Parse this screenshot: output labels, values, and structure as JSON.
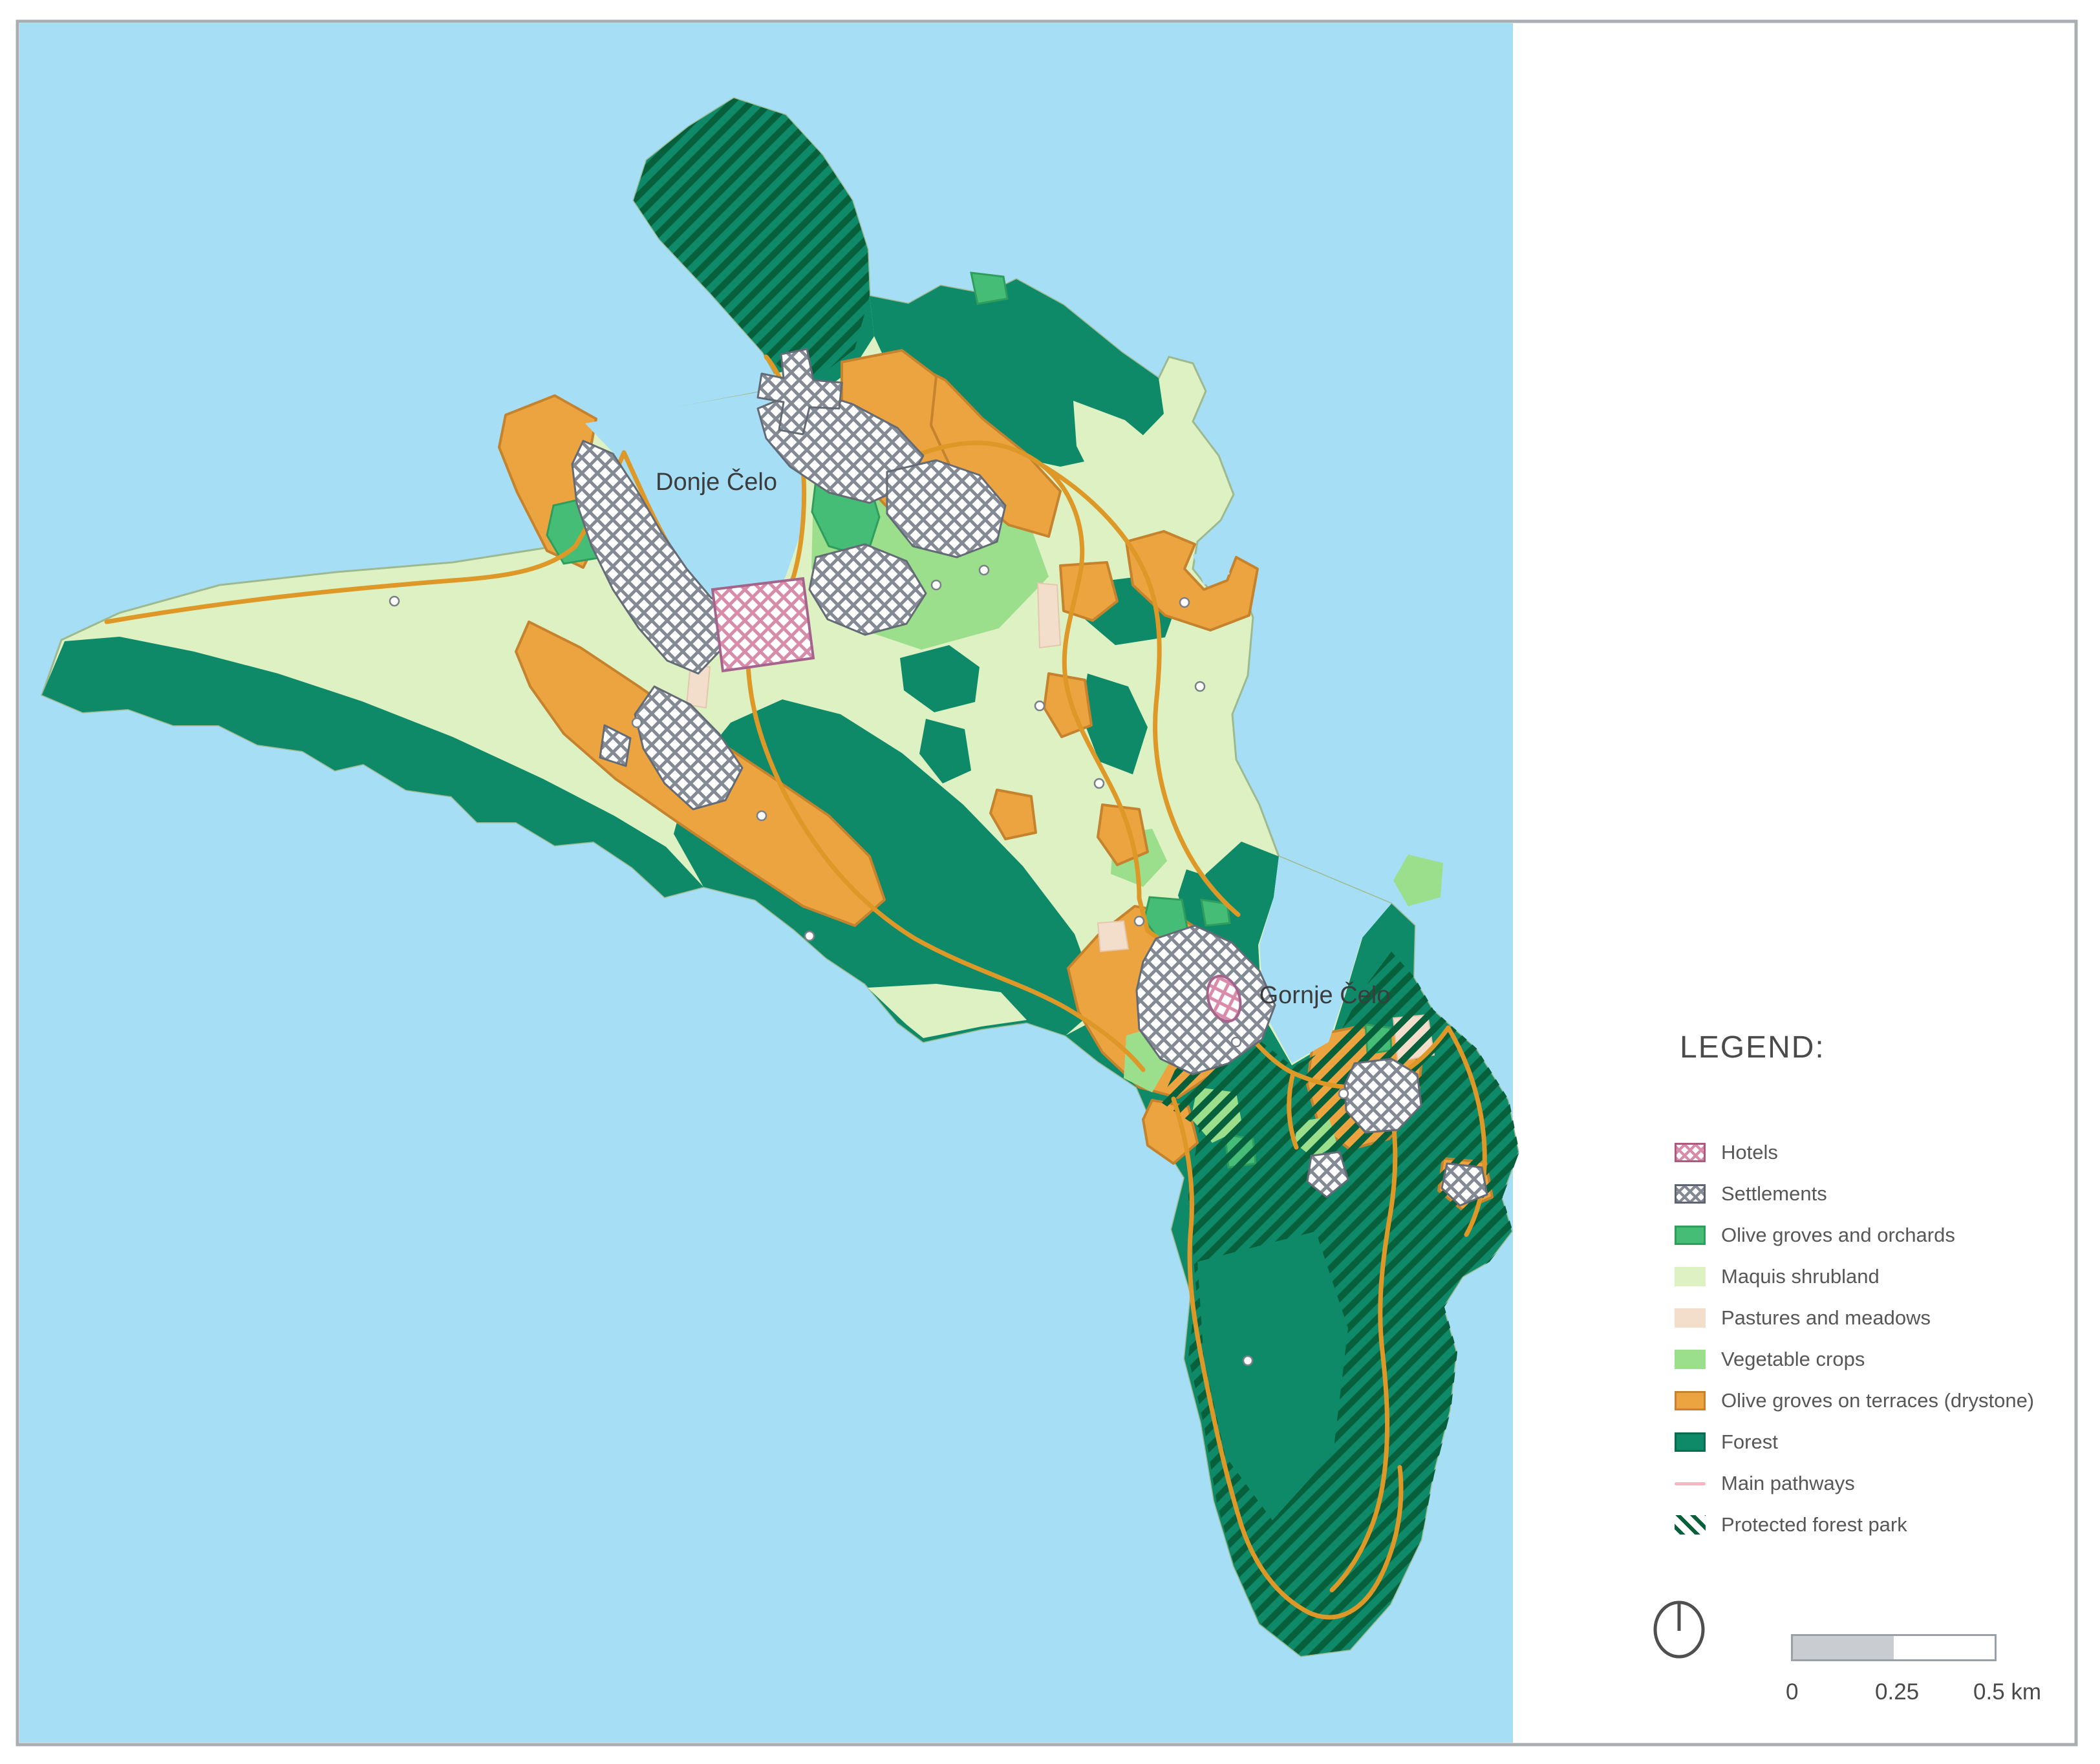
{
  "map": {
    "labels": {
      "settlement_1": "Donje Čelo",
      "settlement_2": "Gornje Čelo"
    }
  },
  "legend": {
    "title": "LEGEND:",
    "items": [
      {
        "label": "Hotels",
        "type": "crosshatch",
        "color": "#d98baa"
      },
      {
        "label": "Settlements",
        "type": "crosshatch",
        "color": "#848a94"
      },
      {
        "label": "Olive groves and orchards",
        "type": "fill",
        "color": "#45bd77"
      },
      {
        "label": "Maquis shrubland",
        "type": "fill",
        "color": "#ddf1c2"
      },
      {
        "label": "Pastures and meadows",
        "type": "fill",
        "color": "#f2decb"
      },
      {
        "label": "Vegetable crops",
        "type": "fill",
        "color": "#9bde8c"
      },
      {
        "label": "Olive groves on terraces (drystone)",
        "type": "fill",
        "color": "#eca440"
      },
      {
        "label": "Forest",
        "type": "fill",
        "color": "#0f8a68"
      },
      {
        "label": "Main pathways",
        "type": "line",
        "color": "#f7b6c2"
      },
      {
        "label": "Protected forest park",
        "type": "diagonal-hatch",
        "color": "#07603c"
      }
    ]
  },
  "scale_bar": {
    "labels": [
      "0",
      "0.25",
      "0.5 km"
    ]
  },
  "colors": {
    "sea": "#a6dff5",
    "maquis": "#ddf1c2",
    "forest": "#0f8a68",
    "orchards": "#45bd77",
    "vegetable_crops": "#9bde8c",
    "pastures": "#f2decb",
    "terraces": "#eca440",
    "pathways_map": "#de9827",
    "frame_border": "#a9aeb3"
  }
}
